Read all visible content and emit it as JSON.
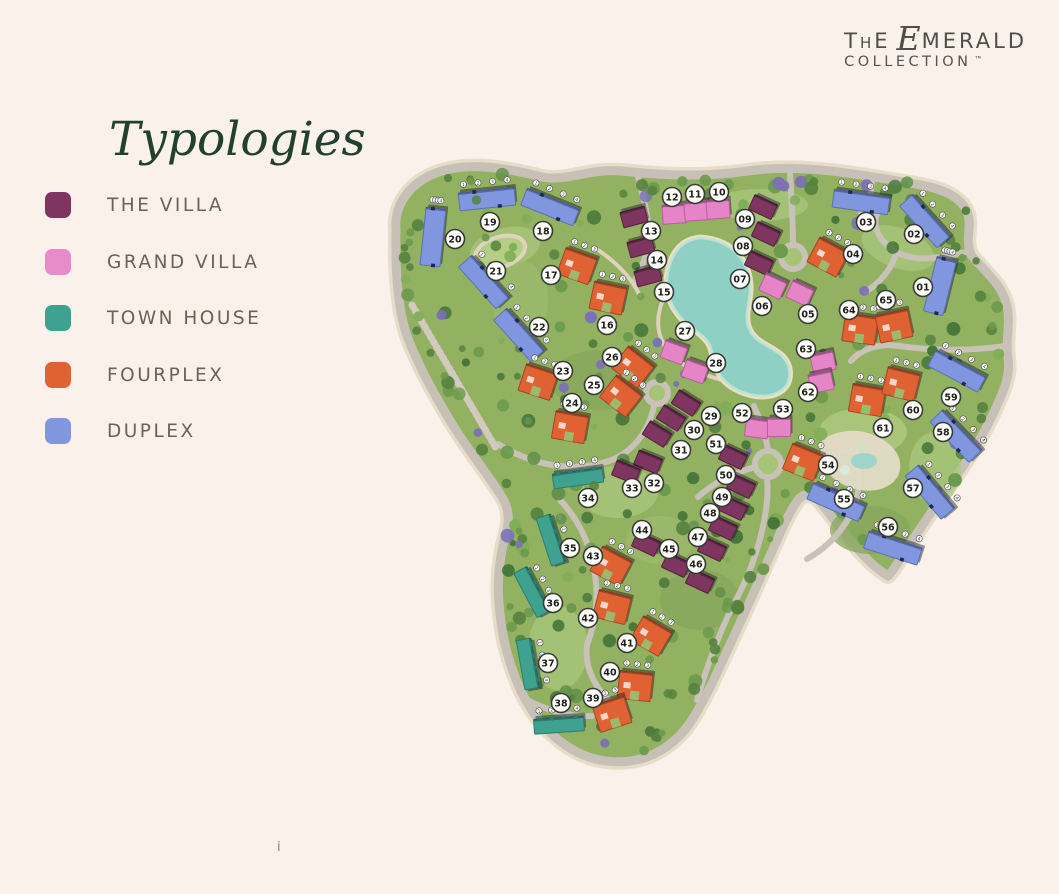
{
  "logo": {
    "t": "T",
    "h": "H",
    "e": "E",
    "script_e": "E",
    "merald": "MERALD",
    "collection": "COLLECTION",
    "tm": "™"
  },
  "title": "Typologies",
  "footnote": "i",
  "legend": [
    {
      "key": "villa",
      "label": "THE VILLA",
      "color": "#7e3560"
    },
    {
      "key": "grand_villa",
      "label": "GRAND VILLA",
      "color": "#e78bc9"
    },
    {
      "key": "town_house",
      "label": "TOWN HOUSE",
      "color": "#3fa18f"
    },
    {
      "key": "fourplex",
      "label": "FOURPLEX",
      "color": "#e06233"
    },
    {
      "key": "duplex",
      "label": "DUPLEX",
      "color": "#8097e0"
    }
  ],
  "typology_colors": {
    "villa": "#7e3560",
    "grand_villa": "#e585c8",
    "town_house": "#3fa18f",
    "fourplex": "#e06233",
    "duplex": "#8097e0"
  },
  "map": {
    "markers": [
      [
        "01",
        923,
        287
      ],
      [
        "02",
        914,
        234
      ],
      [
        "03",
        866,
        222
      ],
      [
        "04",
        853,
        254
      ],
      [
        "05",
        808,
        314
      ],
      [
        "06",
        762,
        306
      ],
      [
        "07",
        740,
        279
      ],
      [
        "08",
        743,
        246
      ],
      [
        "09",
        745,
        219
      ],
      [
        "10",
        719,
        192
      ],
      [
        "11",
        695,
        194
      ],
      [
        "12",
        672,
        197
      ],
      [
        "13",
        651,
        231
      ],
      [
        "14",
        657,
        260
      ],
      [
        "15",
        664,
        292
      ],
      [
        "16",
        607,
        325
      ],
      [
        "17",
        551,
        275
      ],
      [
        "18",
        543,
        231
      ],
      [
        "19",
        490,
        222
      ],
      [
        "20",
        455,
        239
      ],
      [
        "21",
        496,
        271
      ],
      [
        "22",
        539,
        327
      ],
      [
        "23",
        563,
        371
      ],
      [
        "24",
        572,
        403
      ],
      [
        "25",
        594,
        385
      ],
      [
        "26",
        612,
        357
      ],
      [
        "27",
        685,
        331
      ],
      [
        "28",
        716,
        363
      ],
      [
        "29",
        711,
        416
      ],
      [
        "30",
        694,
        430
      ],
      [
        "31",
        681,
        450
      ],
      [
        "32",
        654,
        483
      ],
      [
        "33",
        632,
        488
      ],
      [
        "34",
        588,
        498
      ],
      [
        "35",
        570,
        548
      ],
      [
        "36",
        553,
        603
      ],
      [
        "37",
        548,
        663
      ],
      [
        "38",
        561,
        703
      ],
      [
        "39",
        593,
        698
      ],
      [
        "40",
        610,
        672
      ],
      [
        "41",
        627,
        643
      ],
      [
        "42",
        588,
        618
      ],
      [
        "43",
        593,
        556
      ],
      [
        "44",
        642,
        530
      ],
      [
        "45",
        669,
        549
      ],
      [
        "46",
        696,
        564
      ],
      [
        "47",
        698,
        537
      ],
      [
        "48",
        710,
        513
      ],
      [
        "49",
        722,
        497
      ],
      [
        "50",
        726,
        475
      ],
      [
        "51",
        716,
        444
      ],
      [
        "52",
        742,
        413
      ],
      [
        "53",
        783,
        409
      ],
      [
        "54",
        828,
        465
      ],
      [
        "55",
        844,
        499
      ],
      [
        "56",
        888,
        527
      ],
      [
        "57",
        913,
        488
      ],
      [
        "58",
        943,
        432
      ],
      [
        "59",
        951,
        397
      ],
      [
        "60",
        913,
        410
      ],
      [
        "61",
        883,
        428
      ],
      [
        "62",
        808,
        392
      ],
      [
        "63",
        806,
        349
      ],
      [
        "64",
        849,
        310
      ],
      [
        "65",
        886,
        300
      ]
    ],
    "buildings": [
      [
        "duplex",
        433,
        237,
        6,
        20,
        58
      ],
      [
        "duplex",
        487,
        199,
        -6
      ],
      [
        "duplex",
        550,
        207,
        22
      ],
      [
        "duplex",
        484,
        282,
        48
      ],
      [
        "duplex",
        519,
        335,
        48
      ],
      [
        "duplex",
        940,
        286,
        14,
        20,
        56
      ],
      [
        "duplex",
        925,
        221,
        48
      ],
      [
        "duplex",
        861,
        202,
        8
      ],
      [
        "duplex",
        957,
        371,
        28
      ],
      [
        "duplex",
        956,
        436,
        46
      ],
      [
        "duplex",
        930,
        492,
        50
      ],
      [
        "duplex",
        893,
        548,
        18
      ],
      [
        "duplex",
        836,
        502,
        24
      ],
      [
        "town_house",
        578,
        478,
        -8
      ],
      [
        "town_house",
        551,
        540,
        72
      ],
      [
        "town_house",
        532,
        592,
        62
      ],
      [
        "town_house",
        528,
        664,
        80
      ],
      [
        "town_house",
        559,
        725,
        -4
      ],
      [
        "fourplex",
        577,
        266,
        20
      ],
      [
        "fourplex",
        608,
        298,
        12
      ],
      [
        "fourplex",
        828,
        257,
        28
      ],
      [
        "fourplex",
        538,
        382,
        18
      ],
      [
        "fourplex",
        570,
        427,
        10
      ],
      [
        "fourplex",
        621,
        396,
        38
      ],
      [
        "fourplex",
        633,
        367,
        38
      ],
      [
        "fourplex",
        860,
        329,
        8
      ],
      [
        "fourplex",
        894,
        326,
        -12
      ],
      [
        "fourplex",
        867,
        400,
        10
      ],
      [
        "fourplex",
        901,
        384,
        14
      ],
      [
        "fourplex",
        803,
        462,
        22
      ],
      [
        "fourplex",
        611,
        566,
        28
      ],
      [
        "fourplex",
        612,
        607,
        14
      ],
      [
        "fourplex",
        651,
        636,
        30
      ],
      [
        "fourplex",
        635,
        686,
        6
      ],
      [
        "fourplex",
        612,
        714,
        -18
      ],
      [
        "villa",
        634,
        217,
        -15
      ],
      [
        "villa",
        641,
        247,
        -15
      ],
      [
        "villa",
        648,
        276,
        -15
      ],
      [
        "villa",
        763,
        207,
        25
      ],
      [
        "villa",
        766,
        234,
        25
      ],
      [
        "villa",
        759,
        263,
        25
      ],
      [
        "villa",
        686,
        403,
        32
      ],
      [
        "villa",
        671,
        418,
        32
      ],
      [
        "villa",
        657,
        434,
        32
      ],
      [
        "villa",
        648,
        462,
        22
      ],
      [
        "villa",
        626,
        472,
        22
      ],
      [
        "villa",
        733,
        457,
        25
      ],
      [
        "villa",
        741,
        486,
        25
      ],
      [
        "villa",
        733,
        508,
        25
      ],
      [
        "villa",
        723,
        528,
        25
      ],
      [
        "villa",
        712,
        549,
        25
      ],
      [
        "villa",
        700,
        581,
        25
      ],
      [
        "villa",
        676,
        565,
        25
      ],
      [
        "villa",
        646,
        544,
        25
      ],
      [
        "grand_villa",
        674,
        214,
        -4
      ],
      [
        "grand_villa",
        696,
        211,
        -4
      ],
      [
        "grand_villa",
        718,
        209,
        -4
      ],
      [
        "grand_villa",
        773,
        286,
        25
      ],
      [
        "grand_villa",
        800,
        293,
        25
      ],
      [
        "grand_villa",
        674,
        352,
        20
      ],
      [
        "grand_villa",
        695,
        371,
        20
      ],
      [
        "grand_villa",
        757,
        428,
        8
      ],
      [
        "grand_villa",
        779,
        427,
        0
      ],
      [
        "grand_villa",
        823,
        362,
        -12
      ],
      [
        "grand_villa",
        821,
        382,
        -12
      ]
    ]
  }
}
